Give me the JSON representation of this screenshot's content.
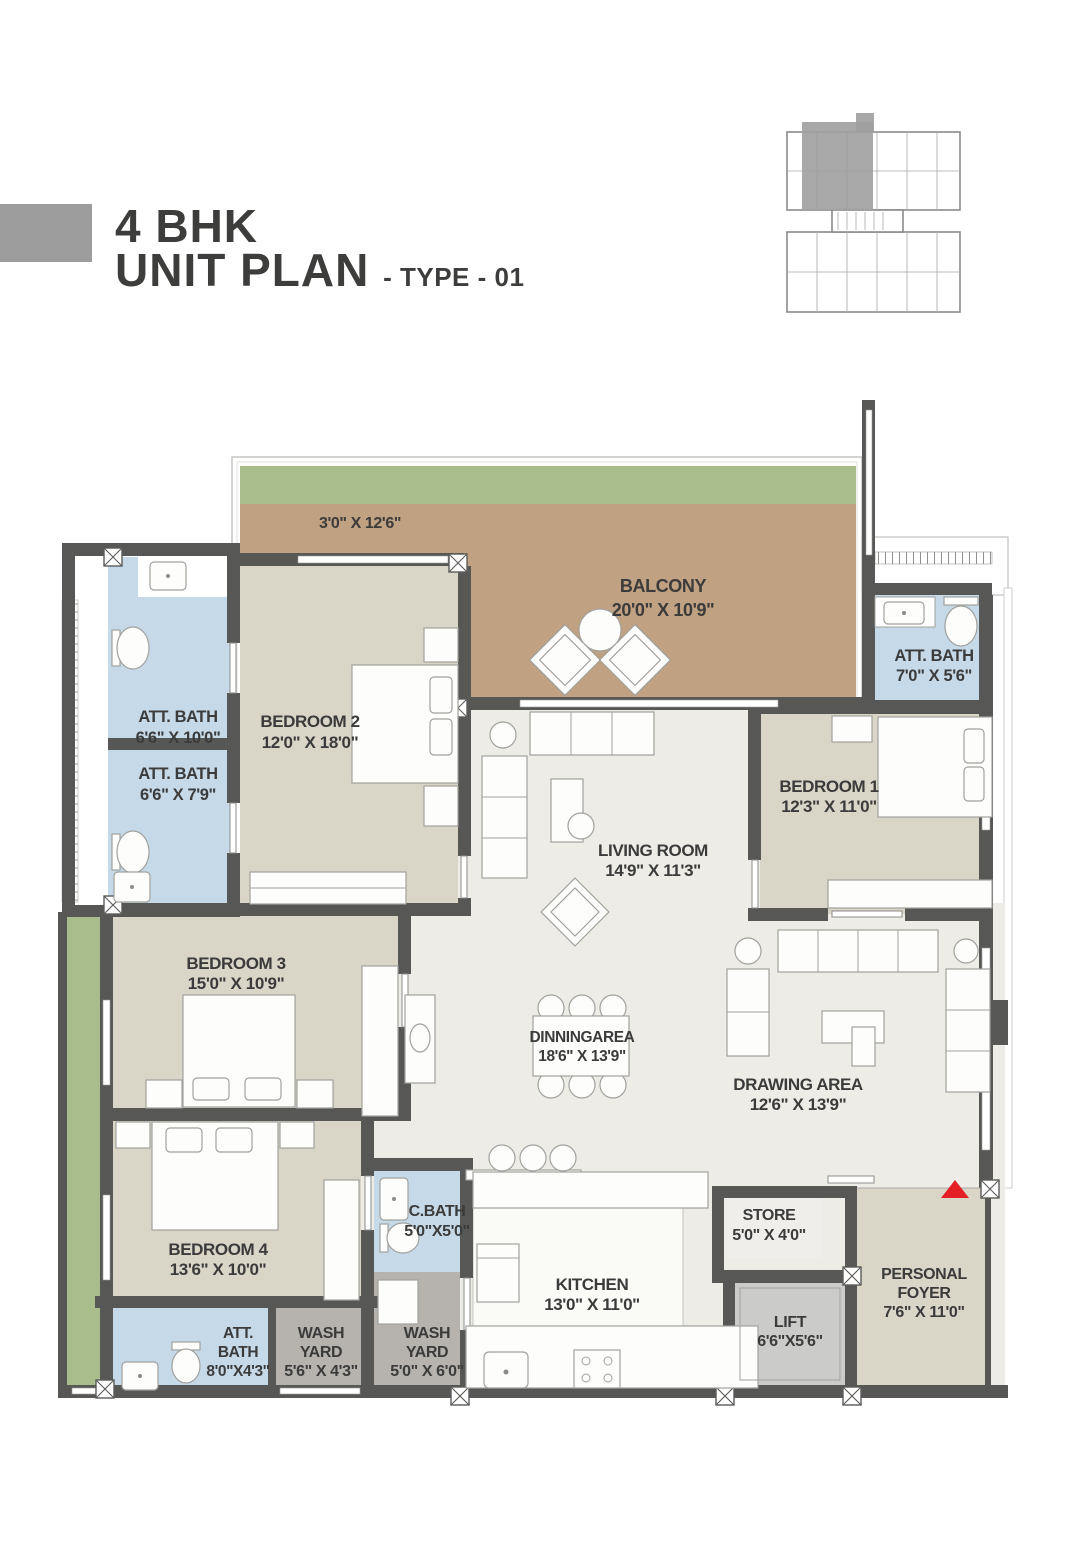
{
  "header": {
    "title_line1": "4 BHK",
    "title_line2": "UNIT PLAN",
    "title_suffix": "- TYPE - 01"
  },
  "colors": {
    "wall": "#575755",
    "living_floor": "#edece7",
    "bedroom_floor": "#d9d5c7",
    "bath_floor": "#c5d9e8",
    "balcony_floor": "#c0a181",
    "planter_green": "#a9bd8c",
    "washyard_floor": "#b6b3ae",
    "lift_floor": "#cbcbc9",
    "store_floor": "#efeeea",
    "kitchen_white": "#fafaf7",
    "label_text": "#3b3b3b",
    "entry_arrow": "#e31e24",
    "keyplan_highlight": "#9e9e9e",
    "title_swatch": "#9d9d9d"
  },
  "plan": {
    "labels": [
      {
        "id": "balcony-strip",
        "lines": [
          "3'0\" X 12'6\""
        ],
        "x": 360,
        "y": 528,
        "size": 16,
        "lh": 20
      },
      {
        "id": "balcony",
        "lines": [
          "BALCONY",
          "20'0\" X 10'9\""
        ],
        "x": 663,
        "y": 592,
        "size": 18,
        "lh": 24
      },
      {
        "id": "att-bath-top-1",
        "lines": [
          "ATT. BATH",
          "6'6\" X 10'0\""
        ],
        "x": 178,
        "y": 722,
        "size": 16.5,
        "lh": 21
      },
      {
        "id": "att-bath-top-2",
        "lines": [
          "ATT. BATH",
          "6'6\" X 7'9\""
        ],
        "x": 178,
        "y": 779,
        "size": 16.5,
        "lh": 21
      },
      {
        "id": "bedroom-2",
        "lines": [
          "BEDROOM 2",
          "12'0\" X 18'0\""
        ],
        "x": 310,
        "y": 727,
        "size": 17,
        "lh": 21
      },
      {
        "id": "att-bath-right",
        "lines": [
          "ATT. BATH",
          "7'0\" X 5'6\""
        ],
        "x": 934,
        "y": 661,
        "size": 16.5,
        "lh": 20
      },
      {
        "id": "bedroom-1",
        "lines": [
          "BEDROOM 1",
          "12'3\" X 11'0\""
        ],
        "x": 829,
        "y": 792,
        "size": 17,
        "lh": 20
      },
      {
        "id": "living-room",
        "lines": [
          "LIVING ROOM",
          "14'9\" X 11'3\""
        ],
        "x": 653,
        "y": 856,
        "size": 17,
        "lh": 20
      },
      {
        "id": "bedroom-3",
        "lines": [
          "BEDROOM 3",
          "15'0\" X 10'9\""
        ],
        "x": 236,
        "y": 969,
        "size": 17,
        "lh": 20
      },
      {
        "id": "dining-area",
        "lines": [
          "DINNINGAREA",
          "18'6\" X 13'9\""
        ],
        "x": 582,
        "y": 1042,
        "size": 15.5,
        "lh": 19
      },
      {
        "id": "drawing-area",
        "lines": [
          "DRAWING AREA",
          "12'6\" X 13'9\""
        ],
        "x": 798,
        "y": 1090,
        "size": 17,
        "lh": 20
      },
      {
        "id": "bedroom-4",
        "lines": [
          "BEDROOM 4",
          "13'6\" X 10'0\""
        ],
        "x": 218,
        "y": 1255,
        "size": 17,
        "lh": 20
      },
      {
        "id": "c-bath",
        "lines": [
          "C.BATH",
          "5'0\"X5'0\""
        ],
        "x": 437,
        "y": 1216,
        "size": 16,
        "lh": 20
      },
      {
        "id": "att-bath-bottom",
        "lines": [
          "ATT.",
          "BATH",
          "8'0\"X4'3\""
        ],
        "x": 238,
        "y": 1338,
        "size": 15.5,
        "lh": 19
      },
      {
        "id": "wash-yard-1",
        "lines": [
          "WASH",
          "YARD",
          "5'6\" X 4'3\""
        ],
        "x": 321,
        "y": 1338,
        "size": 16,
        "lh": 19
      },
      {
        "id": "wash-yard-2",
        "lines": [
          "WASH",
          "YARD",
          "5'0\" X 6'0\""
        ],
        "x": 427,
        "y": 1338,
        "size": 16,
        "lh": 19
      },
      {
        "id": "kitchen",
        "lines": [
          "KITCHEN",
          "13'0\" X 11'0\""
        ],
        "x": 592,
        "y": 1290,
        "size": 17,
        "lh": 20
      },
      {
        "id": "store",
        "lines": [
          "STORE",
          "5'0\" X 4'0\""
        ],
        "x": 769,
        "y": 1220,
        "size": 16,
        "lh": 20
      },
      {
        "id": "lift",
        "lines": [
          "LIFT",
          "6'6\"X5'6\""
        ],
        "x": 790,
        "y": 1327,
        "size": 16,
        "lh": 19
      },
      {
        "id": "personal-foyer",
        "lines": [
          "PERSONAL",
          "FOYER",
          "7'6\" X 11'0\""
        ],
        "x": 924,
        "y": 1279,
        "size": 16,
        "lh": 19
      }
    ]
  }
}
